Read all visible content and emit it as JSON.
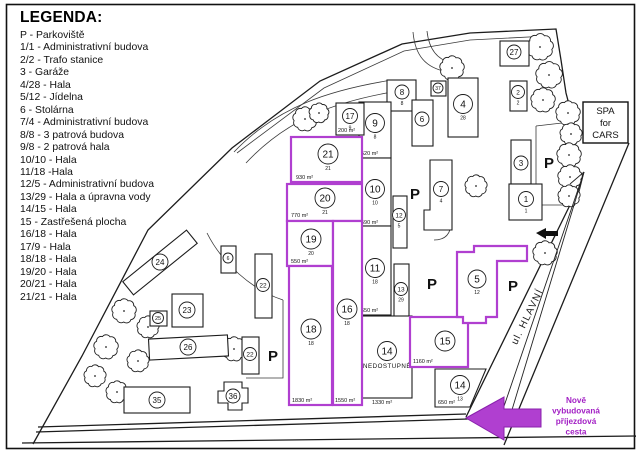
{
  "legend": {
    "title": "LEGENDA:",
    "items": [
      "P - Parkoviště",
      "1/1 - Administrativní budova",
      "2/2 - Trafo stanice",
      "3 - Garáže",
      "4/28 - Hala",
      "5/12 - Jídelna",
      "6 - Stolárna",
      "7/4 - Administrativní budova",
      "8/8 - 3 patrová budova",
      "9/8 - 2 patrová hala",
      "10/10 - Hala",
      "11/18 -Hala",
      "12/5 - Administrativní budova",
      "13/29 - Hala a úpravna vody",
      "14/15 - Hala",
      "15 - Zastřešená plocha",
      "16/18 - Hala",
      "17/9 - Hala",
      "18/18 - Hala",
      "19/20 - Hala",
      "20/21 - Hala",
      "21/21 - Hala"
    ]
  },
  "plan": {
    "colors": {
      "outline": "#1c1c1c",
      "magenta": "#b03fd0",
      "magenta_dark": "#8a21ad",
      "magenta_text": "#a21fc4",
      "road": "#3a3a3a"
    },
    "parking_label": "P",
    "nedostupne_label": "NEDOSTUPNÉ",
    "street_label": {
      "text": "ul. HLAVNÍ",
      "x": 530,
      "y": 318,
      "rotate": -64
    },
    "spa_box": {
      "lines": [
        "SPA",
        "for",
        "CARS"
      ],
      "x": 583,
      "y": 102,
      "w": 45,
      "h": 41
    },
    "new_road_note": {
      "lines": [
        "Nově",
        "vybudovaná",
        "příjezdová",
        "cesta"
      ],
      "cx": 576,
      "y0": 403,
      "lh": 10.5
    },
    "boundary_paths": [
      "M33,444 L82,356 L148,230 L232,148 L320,81 L402,44 L470,33 L556,29 L561,60 L566,93 L571,112 L570,205 L466,417",
      "M38,427 L466,414",
      "M36,432 L468,419",
      "M629,143 L504,445",
      "M22,443 L636,436"
    ],
    "road_paths": [
      "M237,153 L324,88 L404,51 L470,40 L548,36",
      "M234,152 C278,106 330,90 392,80",
      "M246,163 C288,118 336,102 392,92",
      "M413,32 C415,55 425,68 448,72",
      "M427,31 C429,50 438,60 452,63",
      "M536,126 L536,205 L575,205",
      "M536,126 L562,123",
      "M207,233 C222,263 252,290 283,300",
      "M283,300 L283,378 L246,378",
      "M451,222 Q451,240 434,240"
    ],
    "trees": [
      [
        305,
        119,
        11
      ],
      [
        319,
        113,
        9
      ],
      [
        452,
        68,
        11
      ],
      [
        540,
        47,
        12
      ],
      [
        549,
        75,
        12
      ],
      [
        543,
        100,
        11
      ],
      [
        568,
        113,
        11
      ],
      [
        571,
        134,
        10
      ],
      [
        569,
        155,
        11
      ],
      [
        570,
        177,
        11
      ],
      [
        569,
        196,
        10
      ],
      [
        476,
        186,
        10
      ],
      [
        545,
        253,
        11
      ],
      [
        234,
        349,
        11
      ],
      [
        124,
        311,
        11
      ],
      [
        148,
        327,
        10
      ],
      [
        106,
        347,
        11
      ],
      [
        138,
        361,
        10
      ],
      [
        95,
        376,
        10
      ],
      [
        117,
        392,
        10
      ]
    ],
    "p_labels": [
      [
        415,
        194
      ],
      [
        432,
        284
      ],
      [
        513,
        286
      ],
      [
        549,
        163
      ],
      [
        273,
        356
      ]
    ],
    "buildings": [
      {
        "n": "27",
        "rect": [
          500,
          41,
          29,
          25
        ],
        "c": [
          514,
          52
        ],
        "r": 7
      },
      {
        "n": "2",
        "sub": "2",
        "rect": [
          510,
          81,
          17,
          30
        ],
        "c": [
          518,
          92
        ],
        "r": 6.5
      },
      {
        "n": "4",
        "sub": "28",
        "rect": [
          448,
          78,
          30,
          59
        ],
        "c": [
          463,
          104
        ],
        "r": 9.5
      },
      {
        "n": "8",
        "sub": "8",
        "rect": [
          387,
          80,
          29,
          31
        ],
        "c": [
          402,
          92
        ],
        "r": 7
      },
      {
        "n": "6",
        "rect": [
          412,
          100,
          21,
          46
        ],
        "c": [
          422,
          119
        ],
        "r": 7
      },
      {
        "n": "9",
        "sub": "8",
        "area": "520 m²",
        "areaP": [
          361,
          155
        ],
        "rect": [
          359,
          102,
          32,
          56
        ],
        "c": [
          375,
          123
        ],
        "r": 9.5
      },
      {
        "n": "10",
        "sub": "10",
        "area": "590 m²",
        "areaP": [
          361,
          224
        ],
        "rect": [
          359,
          158,
          32,
          68
        ],
        "c": [
          375,
          189
        ],
        "r": 9.5
      },
      {
        "n": "11",
        "sub": "18",
        "area": "650 m²",
        "areaP": [
          361,
          312
        ],
        "rect": [
          359,
          226,
          32,
          89
        ],
        "c": [
          375,
          268
        ],
        "r": 9.5
      },
      {
        "n": "13",
        "sub": "29",
        "rect": [
          394,
          264,
          15,
          56
        ],
        "c": [
          401,
          289
        ],
        "r": 6.5
      },
      {
        "n": "17",
        "sub": "9",
        "area": "200 m²",
        "areaP": [
          338,
          132
        ],
        "rect": [
          336,
          103,
          28,
          32
        ],
        "c": [
          350,
          116
        ],
        "r": 7.5
      },
      {
        "n": "37",
        "rect": [
          431,
          81,
          15,
          15
        ],
        "c": [
          438,
          88
        ],
        "r": 5,
        "fs": 5
      },
      {
        "n": "12",
        "sub": "5",
        "rect": [
          393,
          196,
          14,
          52
        ],
        "c": [
          399,
          215
        ],
        "r": 6.5
      },
      {
        "n": "7",
        "sub": "4",
        "poly": "430,160 452,160 452,230 424,230 424,210 430,210",
        "c": [
          441,
          189
        ],
        "r": 7.5
      },
      {
        "n": "3",
        "rect": [
          511,
          140,
          20,
          44
        ],
        "c": [
          521,
          163
        ],
        "r": 7
      },
      {
        "n": "1",
        "sub": "1",
        "rect": [
          509,
          184,
          33,
          36
        ],
        "c": [
          526,
          199
        ],
        "r": 7.5
      },
      {
        "n": "14",
        "note": "NEDOSTUPNÉ",
        "area": "1330 m²",
        "areaP": [
          372,
          404
        ],
        "rect": [
          362,
          316,
          50,
          82
        ],
        "c": [
          387,
          351
        ],
        "r": 9.5
      },
      {
        "n": "14",
        "sub": "13",
        "area": "650 m²",
        "areaP": [
          438,
          404
        ],
        "poly": "435,369 486,369 470,407 435,407",
        "c": [
          460,
          385
        ],
        "r": 9.5
      },
      {
        "n": "24",
        "rect": [
          119,
          254,
          82,
          17
        ],
        "rot": -39,
        "c": [
          160,
          262
        ],
        "r": 8
      },
      {
        "n": "25",
        "rect": [
          150,
          311,
          17,
          15
        ],
        "c": [
          158,
          318
        ],
        "r": 5.5,
        "fs": 5.5
      },
      {
        "n": "23",
        "rect": [
          172,
          294,
          31,
          33
        ],
        "c": [
          187,
          310
        ],
        "r": 8
      },
      {
        "n": "26",
        "rect": [
          149,
          337,
          79,
          21
        ],
        "rot": -3,
        "c": [
          188,
          347
        ],
        "r": 8
      },
      {
        "n": "22",
        "rect": [
          242,
          337,
          17,
          37
        ],
        "c": [
          250,
          354
        ],
        "r": 6.5
      },
      {
        "n": "22",
        "rect": [
          255,
          254,
          17,
          64
        ],
        "c": [
          263,
          285
        ],
        "r": 6.5
      },
      {
        "n": "6",
        "rect": [
          221,
          246,
          15,
          27
        ],
        "c": [
          228,
          258
        ],
        "r": 5,
        "fs": 5
      },
      {
        "n": "35",
        "rect": [
          124,
          387,
          66,
          26
        ],
        "c": [
          157,
          400
        ],
        "r": 8
      },
      {
        "n": "36",
        "poly": "224,382 242,382 242,388 248,388 248,403 242,403 242,410 228,410 228,403 218,403 218,391 224,391",
        "c": [
          233,
          396
        ],
        "r": 7
      },
      {
        "n": "21",
        "sub": "21",
        "area": "930 m²",
        "areaP": [
          296,
          179
        ],
        "rect": [
          291,
          137,
          71,
          45
        ],
        "c": [
          328,
          154
        ],
        "r": 10,
        "mag": true
      },
      {
        "n": "20",
        "sub": "21",
        "area": "770 m²",
        "areaP": [
          291,
          217
        ],
        "rect": [
          287,
          184,
          75,
          37
        ],
        "c": [
          325,
          198
        ],
        "r": 10,
        "mag": true
      },
      {
        "n": "19",
        "sub": "20",
        "area": "550 m²",
        "areaP": [
          291,
          263
        ],
        "rect": [
          287,
          221,
          46,
          45
        ],
        "c": [
          311,
          239
        ],
        "r": 10,
        "mag": true
      },
      {
        "n": "18",
        "sub": "18",
        "area": "1830 m²",
        "areaP": [
          292,
          402
        ],
        "rect": [
          289,
          266,
          43,
          139
        ],
        "c": [
          311,
          329
        ],
        "r": 10,
        "mag": true
      },
      {
        "n": "16",
        "sub": "18",
        "area": "1550 m²",
        "areaP": [
          335,
          402
        ],
        "rect": [
          333,
          221,
          29,
          184
        ],
        "c": [
          347,
          309
        ],
        "r": 10,
        "mag": true
      },
      {
        "n": "15",
        "area": "1160 m²",
        "areaP": [
          413,
          363
        ],
        "rect": [
          410,
          317,
          58,
          50
        ],
        "c": [
          445,
          341
        ],
        "r": 10,
        "mag": true
      },
      {
        "n": "5",
        "sub": "12",
        "poly": "457,252 474,252 474,246 527,246 527,261 497,261 497,317 486,317 486,323 463,323 463,317 457,317",
        "c": [
          477,
          279
        ],
        "r": 9,
        "mag": true
      }
    ]
  }
}
